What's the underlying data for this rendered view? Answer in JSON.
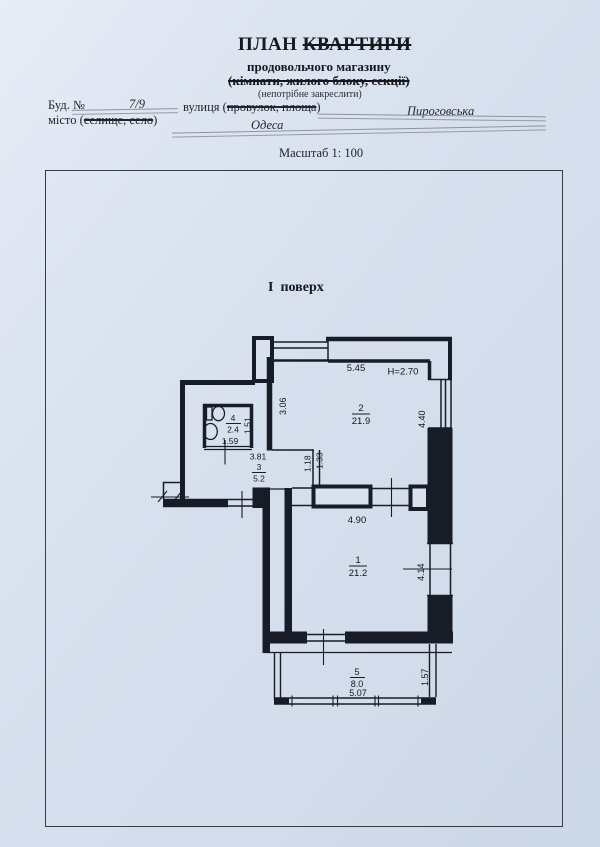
{
  "document": {
    "title_plan": "ПЛАН",
    "title_struck": "КВАРТИРИ",
    "subtitle": "продовольчого магазину",
    "crossed_line": "(кімнати, жилого блоку, секції)",
    "note": "(непотрібне закреслити)",
    "building_label": "Буд. №",
    "building_number": "7/9",
    "street_label_prefix": "вулиця (",
    "street_label_struck": "провулок, площа",
    "street_label_suffix": ")",
    "street_value": "Пироговська",
    "city_label_prefix": "місто (",
    "city_label_struck": "селище, село",
    "city_label_suffix": ")",
    "city_value": "Одеса",
    "scale_label": "Масштаб 1: 100",
    "floor_label": "І  поверх"
  },
  "plan": {
    "rooms": [
      {
        "number": "1",
        "area": "21.2"
      },
      {
        "number": "2",
        "area": "21.9"
      },
      {
        "number": "3",
        "area": "5.2"
      },
      {
        "number": "4",
        "area": "2.4"
      },
      {
        "number": "5",
        "area": "8.0"
      }
    ],
    "dimensions": {
      "room2_width": "5.45",
      "height_note": "Н=2.70",
      "room2_left_side": "3.06",
      "room2_right_side": "4.40",
      "wc_side": "1.51",
      "wc_door_width": "1.59",
      "room3_width": "3.81",
      "partition_a": "1.18",
      "partition_b": "1.33",
      "room1_width": "4.90",
      "room1_right_side": "4.14",
      "porch_width": "5.07",
      "porch_depth": "1.57"
    }
  },
  "colors": {
    "paper": "#d8e1ee",
    "ink": "#171c26",
    "pencil": "#8d93a0"
  }
}
